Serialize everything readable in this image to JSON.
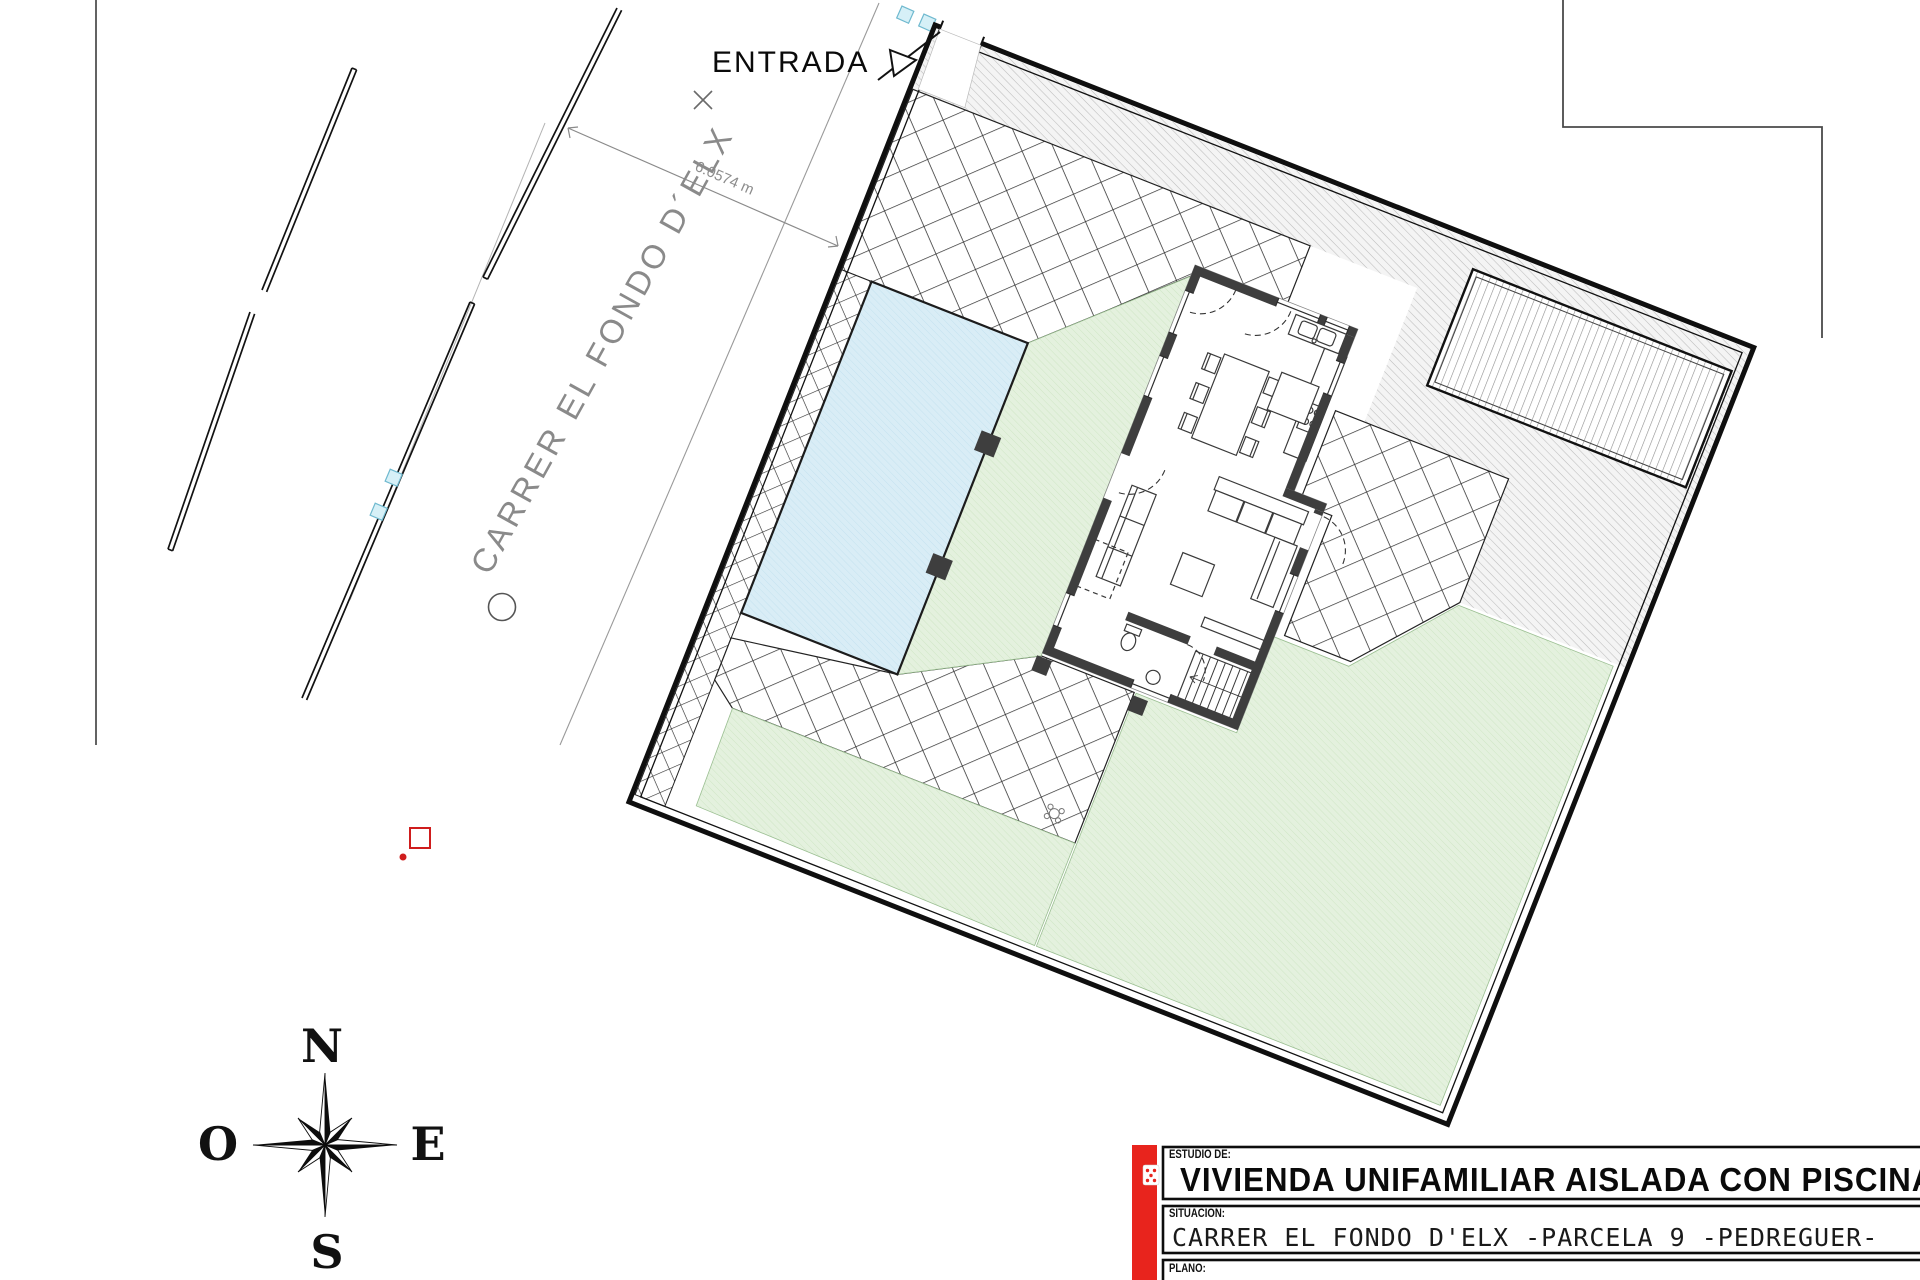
{
  "plan": {
    "street_label": "CARRER  EL FONDO D´ELX",
    "entrance_label": "ENTRADA",
    "street_width_dimension": "6.0574 m"
  },
  "compass": {
    "north": "N",
    "east": "E",
    "south": "S",
    "west": "O"
  },
  "title_block": {
    "field1_label": "ESTUDIO DE:",
    "field1_value": "VIVIENDA UNIFAMILIAR AISLADA CON PISCINA",
    "field2_label": "SITUACION:",
    "field2_value": "CARRER EL FONDO D'ELX -PARCELA 9  -PEDREGUER-",
    "field3_label": "PLANO:",
    "accent_color": "#e8241d"
  },
  "colors": {
    "pool": "#d9edf6",
    "lawn": "#e4f1de",
    "wall": "#3e3e3e",
    "accent": "#e8241d"
  }
}
